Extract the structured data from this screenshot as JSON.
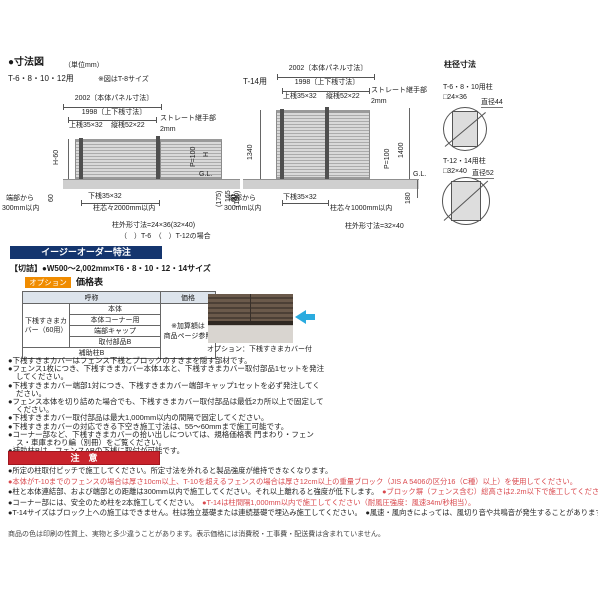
{
  "header": {
    "title": "●寸法図",
    "unit": "（単位mm）",
    "left_model": "T-6・8・10・12用",
    "left_note": "※図はT-8サイズ",
    "right_model": "T-14用"
  },
  "left_diagram": {
    "panel_dim": "2002〔本体パネル寸法〕",
    "rail_dim": "1998〔上下桟寸法〕",
    "top_rail": "上桟35×32",
    "vertical_rail": "縦桟52×22",
    "joint_label": "ストレート継手部",
    "joint_gap": "2mm",
    "height_label": "H-60",
    "pitch_label": "P=100",
    "h_label": "H",
    "gl_label": "G.L.",
    "under_gap": "60",
    "edge_line1": "端部から",
    "edge_line2": "300mm以内",
    "bottom_rail": "下桟35×32",
    "post_pitch": "柱芯々2000mm以内",
    "depth_a": "(175)",
    "depth_b": "165",
    "depth_c": "(180)",
    "post_note1": "柱外形寸法=24×36(32×40)",
    "post_note2": "（　）T-6　（　）T-12の場合"
  },
  "right_diagram": {
    "panel_dim": "2002〔本体パネル寸法〕",
    "rail_dim": "1998〔上下桟寸法〕",
    "top_rail": "上桟35×32",
    "vertical_rail": "縦桟52×22",
    "joint_label": "ストレート継手部",
    "joint_gap": "2mm",
    "height_label": "1340",
    "total_height": "1400",
    "pitch_label": "P=100",
    "gl_label": "G.L.",
    "under_gap": "60",
    "edge_line1": "端部から",
    "edge_line2": "300mm以内",
    "bottom_rail": "下桟35×32",
    "post_pitch": "柱芯々1000mm以内",
    "embed_depth": "180",
    "post_note": "柱外形寸法=32×40"
  },
  "post_section": {
    "title": "柱径寸法",
    "post1": {
      "label": "T-6・8・10用柱",
      "size": "□24×36",
      "diameter": "直径44"
    },
    "post2": {
      "label": "T-12・14用柱",
      "size": "□32×40",
      "diameter": "直径52"
    }
  },
  "easy_order": {
    "banner": "イージーオーダー特注",
    "spec": "【切詰】●W500～2,002mm×T6・8・10・12・14サイズ"
  },
  "option": {
    "badge": "オプション",
    "title": "価格表",
    "table": {
      "col_name": "呼称",
      "col_price": "価格",
      "group_label": "下桟すきまカバー（60用）",
      "items": [
        "本体",
        "本体コーナー用",
        "端部キャップ",
        "取付部品B"
      ],
      "aux_row": "補助柱B",
      "price_note1": "※加算額は",
      "price_note2": "商品ページ参照"
    },
    "photo_caption": "オプション：下桟すきまカバー付",
    "arrow_icon": "left-arrow"
  },
  "notes": [
    "●下桟すきまカバーはフェンス下桟とブロックのすきまを隠す部材です。",
    "●フェンス1枚につき、下桟すきまカバー本体1本と、下桟すきまカバー取付部品1セットを発注してください。",
    "●下桟すきまカバー端部1対につき、下桟すきまカバー端部キャップ1セットを必ず発注してください。",
    "●フェンス本体を切り詰めた場合でも、下桟すきまカバー取付部品は最低2カ所以上で固定してください。",
    "●下桟すきまカバー取付部品は最大1,000mm以内の間隔で固定してください。",
    "●下桟すきまカバーの対応できる下空き施工寸法は、55～60mmまで施工可能です。",
    "●コーナー部など、下桟すきまカバーの拾い出しについては、規格価格表 門まわり・フェンス・車庫まわり編（別冊）をご覧ください。",
    "●補助柱Bは、フェンスABの下桟に取付が可能です。"
  ],
  "caution": {
    "banner": "注　意",
    "lines": [
      {
        "segments": [
          {
            "text": "●所定の柱取付ピッチで施工してください。所定寸法を外れると製品強度が維持できなくなります。",
            "red": false
          }
        ]
      },
      {
        "segments": [
          {
            "text": "●本体がT-10までのフェンスの場合は厚さ10cm以上、T-10を超えるフェンスの場合は厚さ12cm以上の重量ブロック（JIS A 5406の区分16（C種）以上）を使用してください。",
            "red": true
          }
        ]
      },
      {
        "segments": [
          {
            "text": "●柱と本体連結部、および端部との距離は300mm以内で施工してください。それ以上離れると強度が低下します。　",
            "red": false
          },
          {
            "text": "●ブロック塀（フェンス含む）総高さは2.2m以下で施工してください。",
            "red": true
          }
        ]
      },
      {
        "segments": [
          {
            "text": "●コーナー部には、安全のため柱を2本施工してください。　",
            "red": false
          },
          {
            "text": "●T-14は柱間隔1,000mm以内で施工してください（耐風圧強度：風速34m/秒相当）。",
            "red": true
          }
        ]
      },
      {
        "segments": [
          {
            "text": "●T-14サイズはブロック上への施工はできません。柱は独立基礎または連続基礎で埋込み施工してください。　",
            "red": false
          },
          {
            "text": "●風速・風向きによっては、風切り音や共鳴音が発生することがあります。",
            "red": false
          }
        ]
      }
    ]
  },
  "footer": "商品の色は印刷の性質上、実物と多少違うことがあります。表示価格には消費税・工事費・配送費は含まれていません。",
  "colors": {
    "banner_navy": "#14356e",
    "badge_orange": "#f08c00",
    "caution_red": "#c8232c",
    "warning_text_red": "#d9484d",
    "arrow_cyan": "#2aabdf"
  }
}
